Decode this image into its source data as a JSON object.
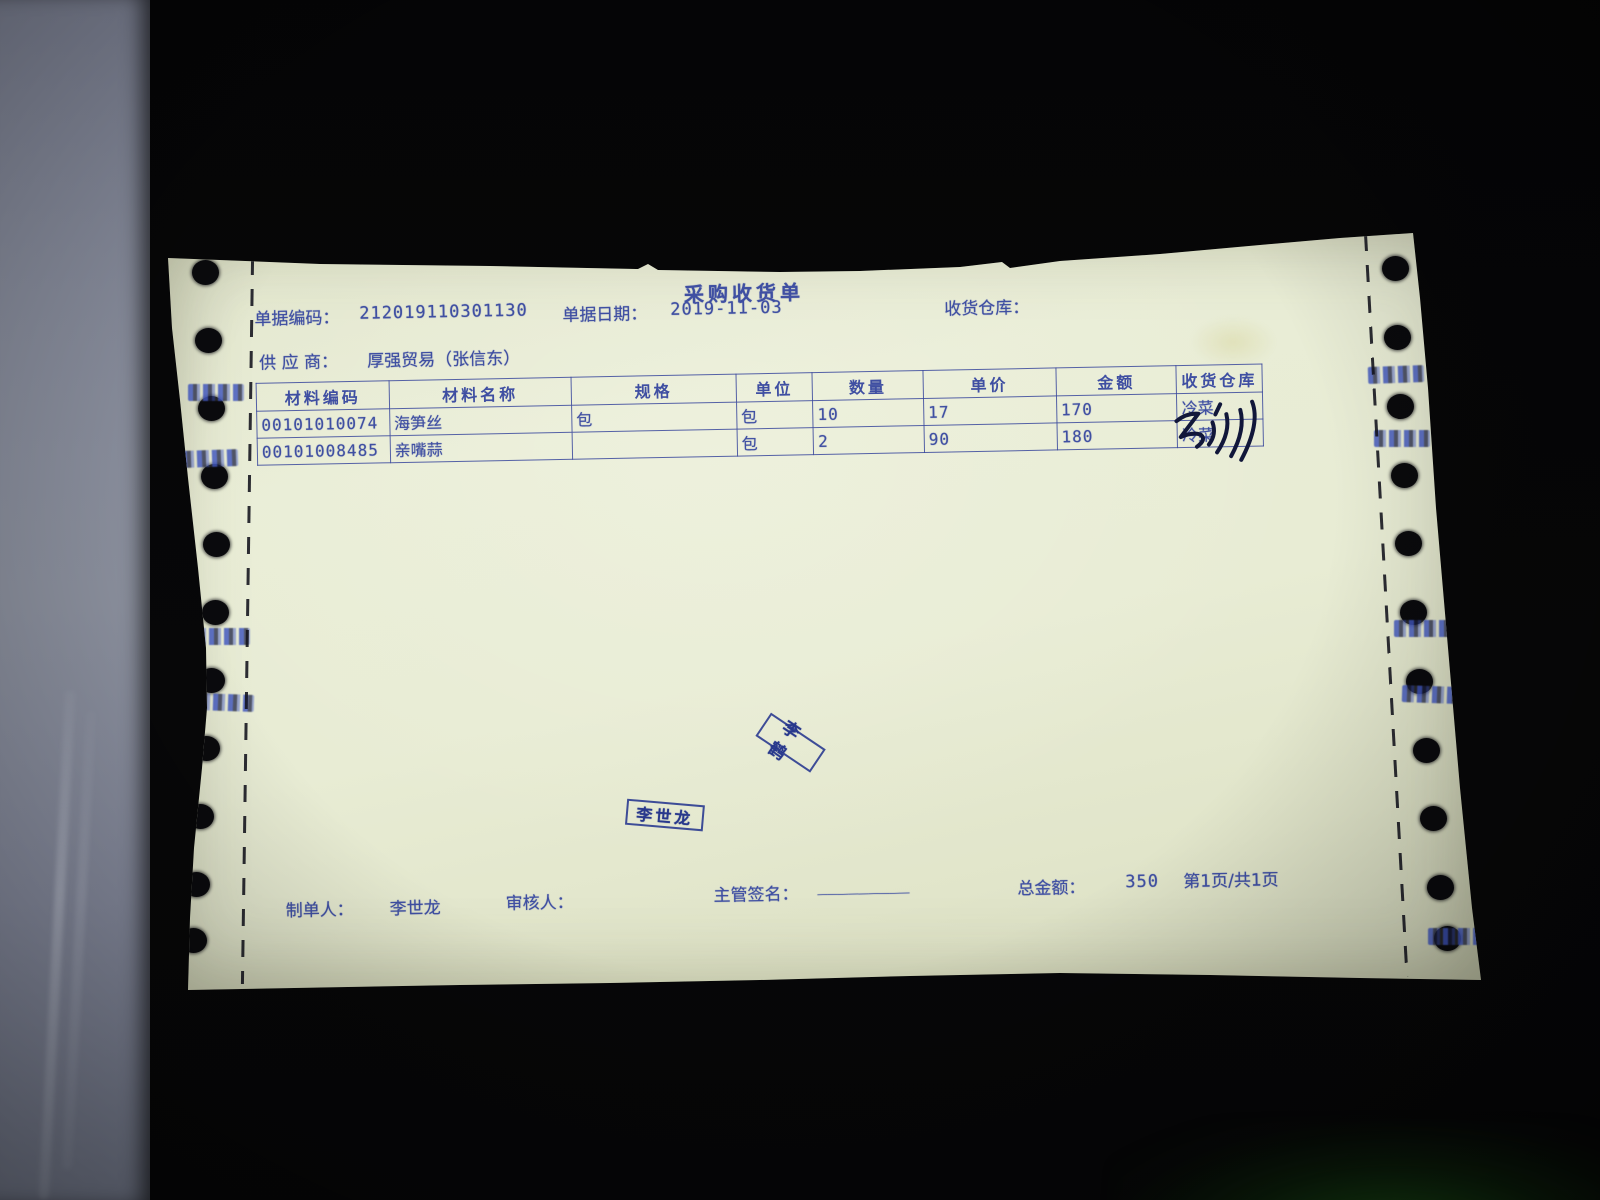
{
  "receipt": {
    "title": "采购收货单",
    "header": {
      "doc_no_label": "单据编码：",
      "doc_no": "212019110301130",
      "date_label": "单据日期：",
      "date": "2019-11-03",
      "warehouse_label": "收货仓库：",
      "warehouse_value": "",
      "supplier_label": "供 应 商：",
      "supplier": "厚强贸易（张信东）"
    },
    "table": {
      "headers": [
        "材料编码",
        "材料名称",
        "规格",
        "单位",
        "数量",
        "单价",
        "金额",
        "收货仓库"
      ],
      "rows": [
        [
          "00101010074",
          "海笋丝",
          "包",
          "包",
          "10",
          "17",
          "170",
          "冷菜"
        ],
        [
          "00101008485",
          "亲嘴蒜",
          "",
          "包",
          "2",
          "90",
          "180",
          "冷菜"
        ]
      ],
      "handwritten_mark": "illegible pen scribble"
    },
    "stamps": {
      "stamp1": "李鹤",
      "stamp2": "李世龙"
    },
    "footer": {
      "maker_label": "制单人：",
      "maker": "李世龙",
      "reviewer_label": "审核人：",
      "reviewer": "",
      "signature_label": "主管签名：",
      "signature_line": "_________",
      "total_label": "总金额：",
      "total": "350",
      "page_info": "第1页/共1页"
    },
    "colors": {
      "paper": "#e8ecd4",
      "print_ink": "#3f4fa2",
      "stamp_ink": "#28388c",
      "pen_ink": "#11173a",
      "background": "#060607",
      "wall": "#8b90a0"
    }
  }
}
